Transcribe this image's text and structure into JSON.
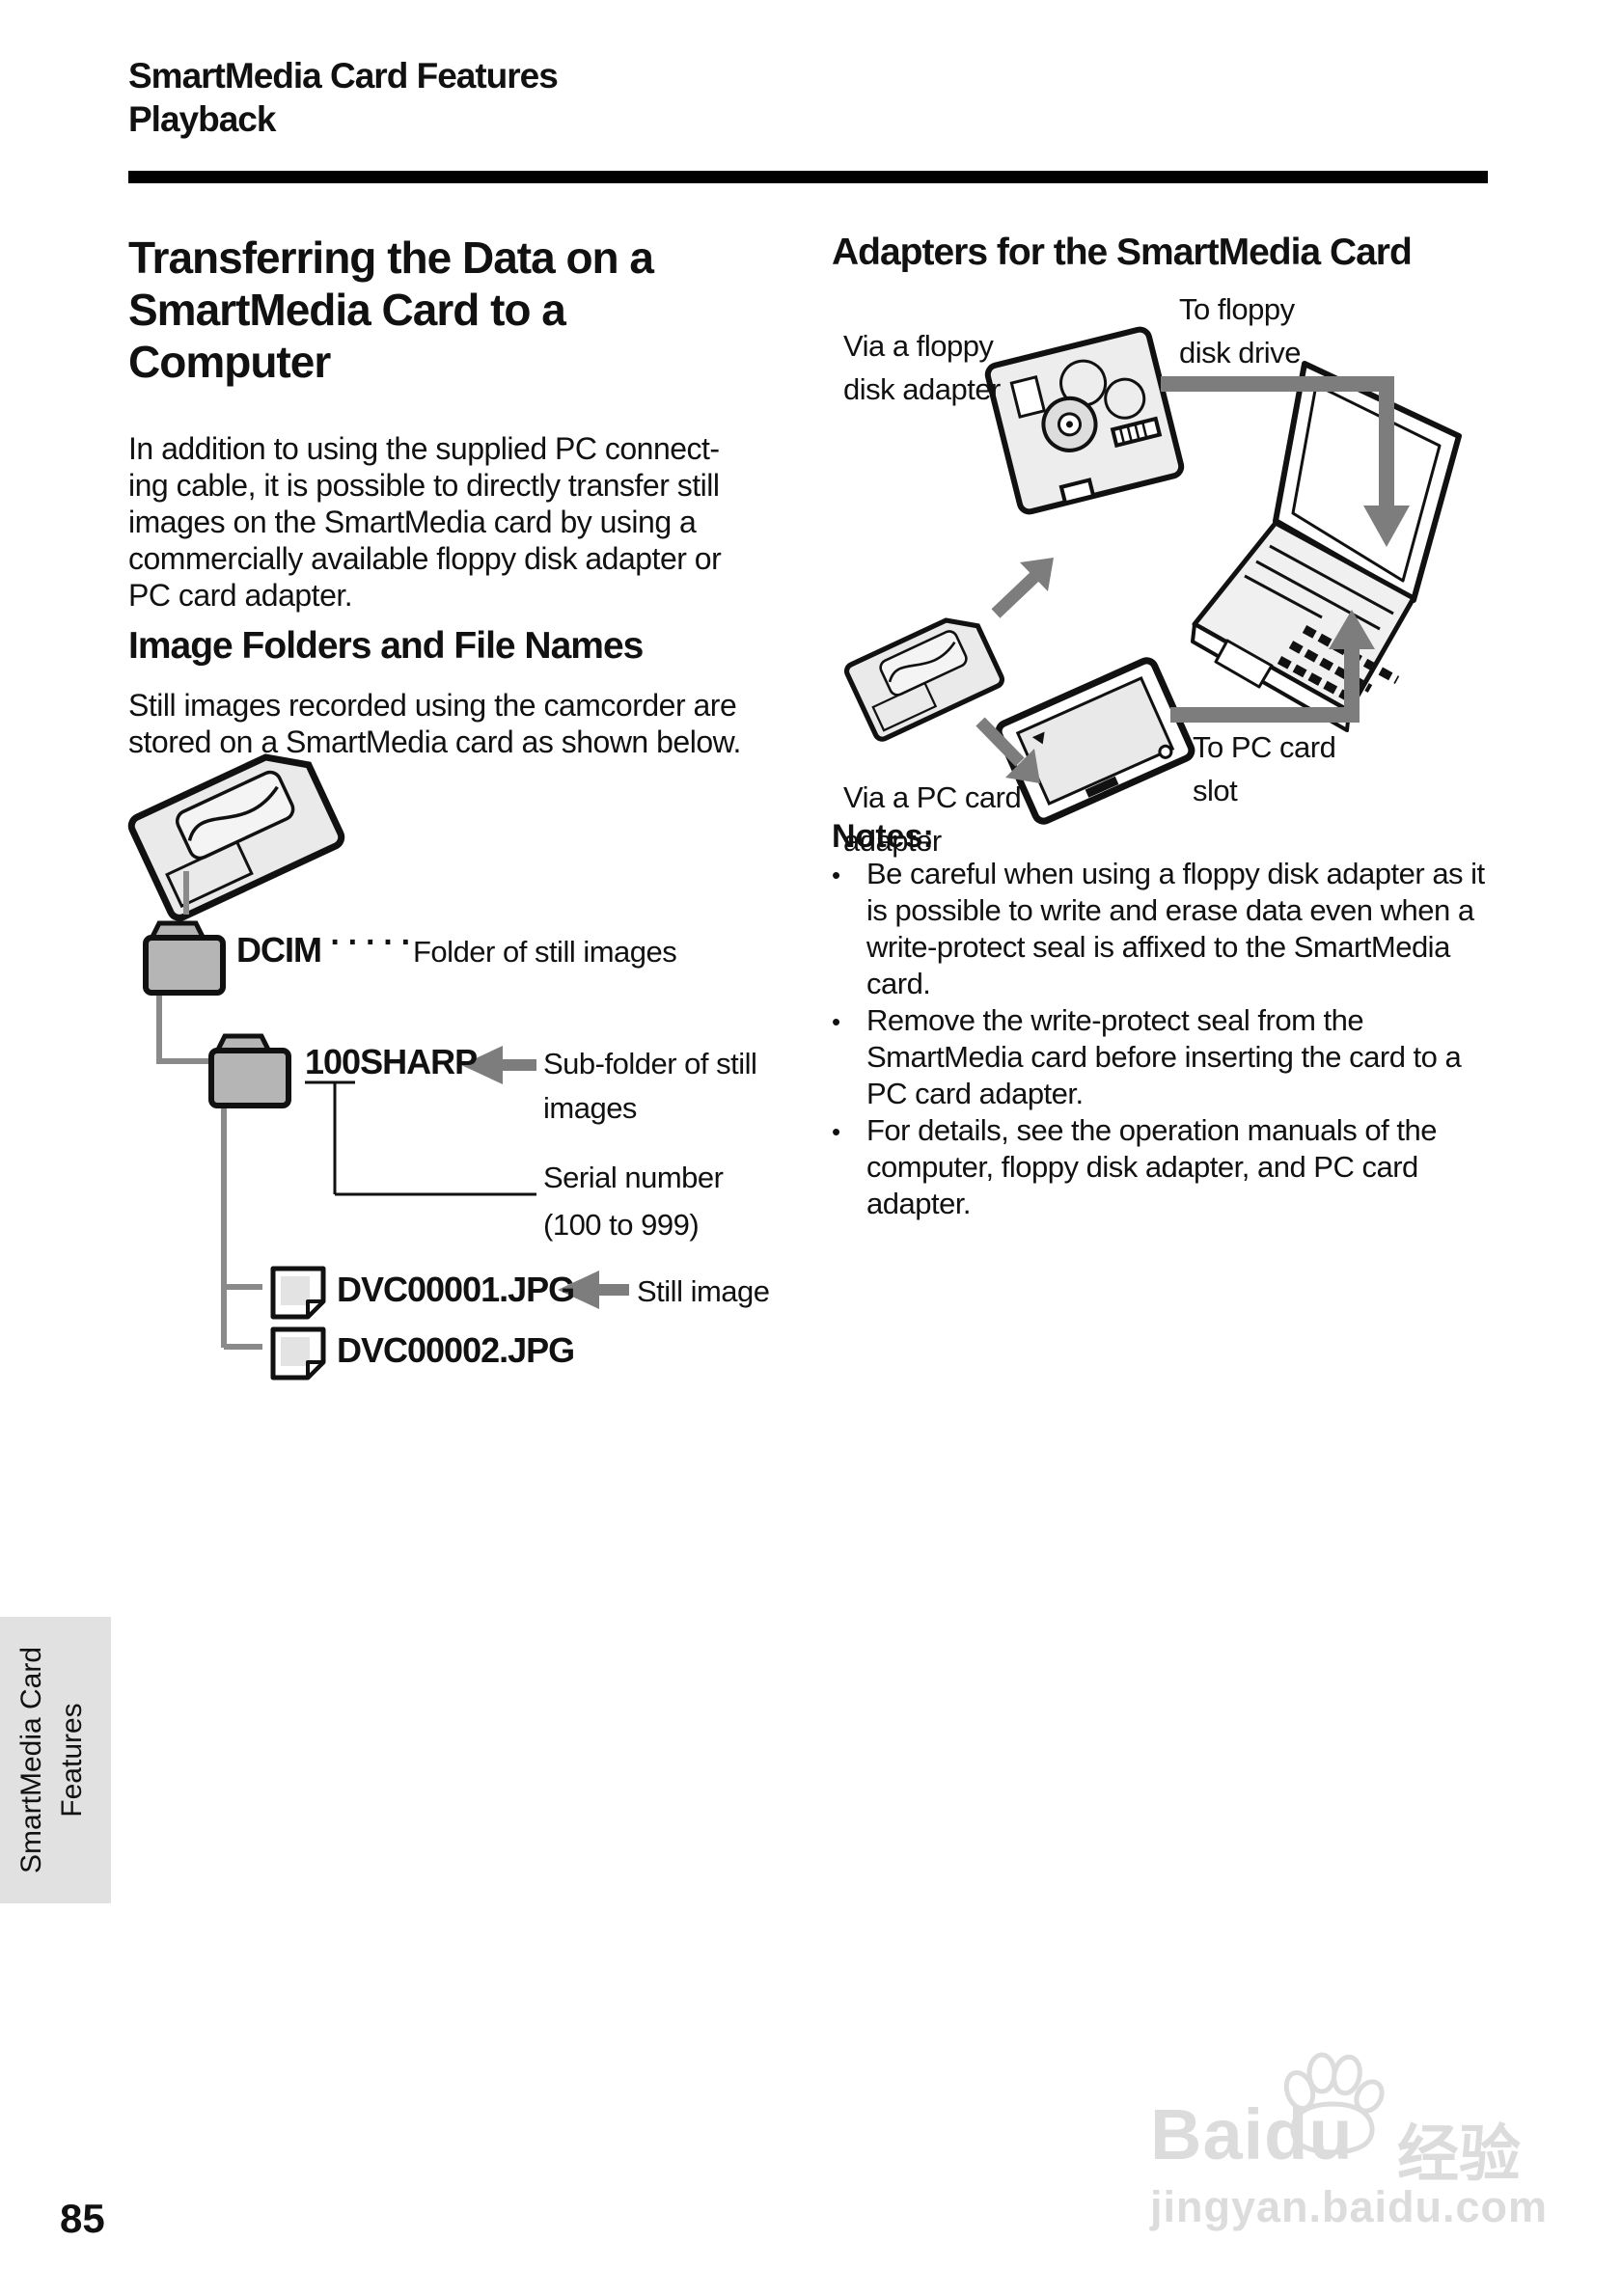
{
  "header": {
    "line1": "SmartMedia Card Features",
    "line2": "Playback"
  },
  "left": {
    "title_lines": [
      "Transferring the Data on a",
      "SmartMedia Card to a",
      "Computer"
    ],
    "intro_lines": [
      "In addition to using the supplied PC connect-",
      "ing cable, it is possible to directly transfer still",
      "images on the SmartMedia card by using a",
      "commercially available floppy disk adapter or",
      "PC card adapter."
    ],
    "subheading": "Image Folders and File Names",
    "sub_intro_lines": [
      "Still images recorded using the camcorder are",
      "stored on a SmartMedia card as shown below."
    ],
    "tree": {
      "root_folder_label": "DCIM",
      "root_dots": "······",
      "root_annotation": "Folder of still images",
      "subfolder_label": "100SHARP",
      "subfolder_annotation_lines": [
        "Sub-folder of still",
        "images"
      ],
      "serial_annotation_lines": [
        "Serial number",
        "(100 to 999)"
      ],
      "file1_label": "DVC00001.JPG",
      "file1_annotation": "Still image",
      "file2_label": "DVC00002.JPG"
    }
  },
  "right": {
    "heading": "Adapters for the SmartMedia Card",
    "labels": {
      "via_floppy_lines": [
        "Via a floppy",
        "disk adapter"
      ],
      "to_floppy_lines": [
        "To floppy",
        "disk drive"
      ],
      "via_pc_lines": [
        "Via a PC card",
        "adapter"
      ],
      "to_pc_lines": [
        "To PC card",
        "slot"
      ]
    },
    "notes": {
      "heading": "Notes:",
      "bullet": "•",
      "item1_lines": [
        "Be careful when using a floppy disk adapter as it",
        "is possible to write and erase data even when a",
        "write-protect seal is affixed to the SmartMedia",
        "card."
      ],
      "item2_lines": [
        "Remove the write-protect seal from the",
        "SmartMedia card before inserting the card to a",
        "PC card adapter."
      ],
      "item3_lines": [
        "For details, see the operation manuals of the",
        "computer, floppy disk adapter, and PC card",
        "adapter."
      ]
    }
  },
  "sidebar_tab_lines": [
    "SmartMedia Card",
    "Features"
  ],
  "page_number": "85",
  "watermark": {
    "brand": "Baidu",
    "brand_cn": "经验",
    "url": "jingyan.baidu.com",
    "paw_icon": "baidu-paw-icon"
  },
  "colors": {
    "arrow_gray": "#7d7d7d",
    "tree_line_gray": "#8a8a8a",
    "folder_gray": "#b5b5b5",
    "tab_gray": "#e1e1e1",
    "watermark_gray": "#dcdcdc",
    "rule_black": "#000000"
  }
}
